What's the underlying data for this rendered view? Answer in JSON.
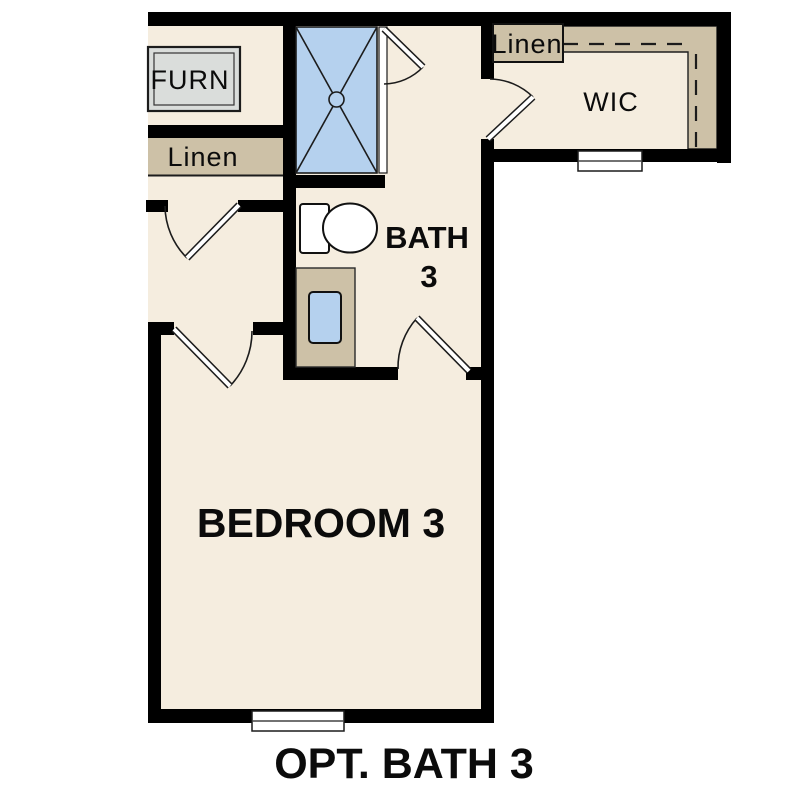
{
  "caption": {
    "title": "OPT. BATH 3"
  },
  "rooms": {
    "furnace": {
      "label": "FURN"
    },
    "hall_linen": {
      "label": "Linen"
    },
    "bath": {
      "line1": "BATH",
      "line2": "3"
    },
    "wic": {
      "label": "WIC"
    },
    "wic_linen": {
      "label": "Linen"
    },
    "bedroom": {
      "label": "BEDROOM 3"
    }
  },
  "colors": {
    "background": "#ffffff",
    "floor": "#f5eddf",
    "wall": "#000000",
    "closet_tan": "#cdc1a7",
    "water_blue": "#b5d1ee",
    "furnace_gray": "#dadddb"
  }
}
